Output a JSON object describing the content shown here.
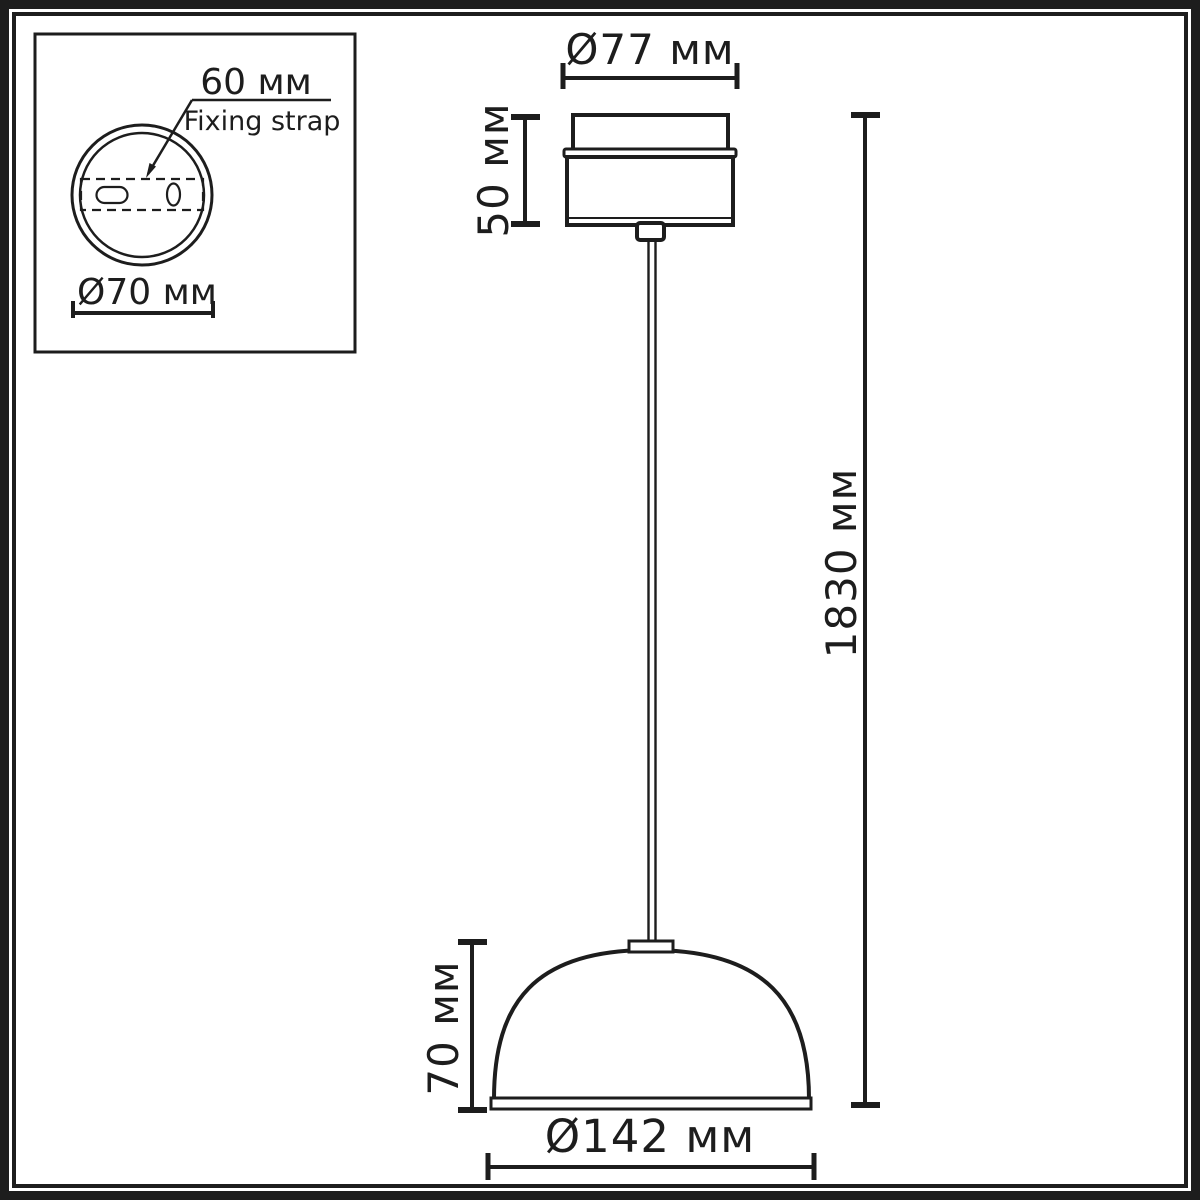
{
  "colors": {
    "line": "#1d1d1d",
    "background": "#ffffff"
  },
  "inset_top_view": {
    "strap_width_label": "60 мм",
    "strap_name_label": "Fixing strap",
    "base_diameter_label": "Ø70 мм"
  },
  "side_view": {
    "canopy_diameter_label": "Ø77 мм",
    "canopy_height_label": "50 мм",
    "suspension_length_label": "1830 мм",
    "shade_height_label": "70 мм",
    "shade_diameter_label": "Ø142 мм"
  }
}
